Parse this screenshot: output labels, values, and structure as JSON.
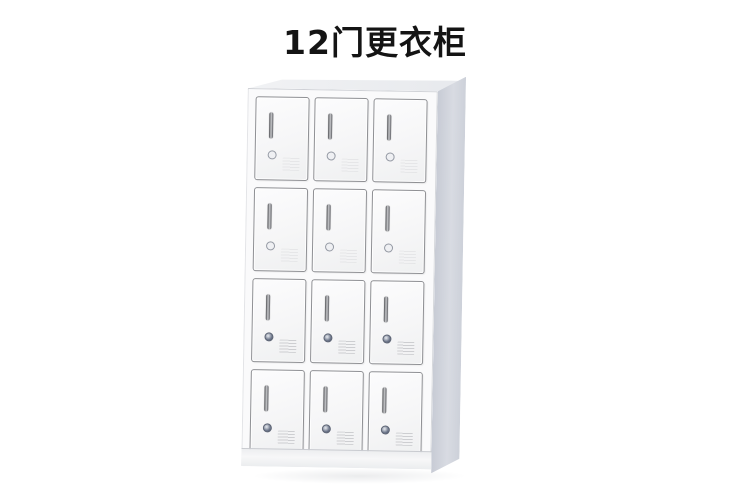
{
  "title": {
    "text": "12门更衣柜"
  },
  "canvas": {
    "width": 750,
    "height": 499,
    "background_color": "#ffffff",
    "title_color": "#141414"
  },
  "product_image": {
    "description": "white steel 12-door changing locker shown in slight right-side perspective",
    "grid": {
      "rows": 4,
      "columns": 3
    },
    "door_count": 12,
    "door_parts": [
      "recessed-handle",
      "round-cam-lock",
      "vent-grille"
    ],
    "colors": {
      "door_face": "#f6f6f7",
      "door_border": "#8f9094",
      "cabinet_frame": "#fafafb",
      "side_panel": "#cbcfd8",
      "top_panel": "#eceef1",
      "plinth": "#f2f3f4",
      "handle": "#5f6065",
      "lock_ring": "#5d6474",
      "vent_lines": "#cdced1"
    }
  }
}
